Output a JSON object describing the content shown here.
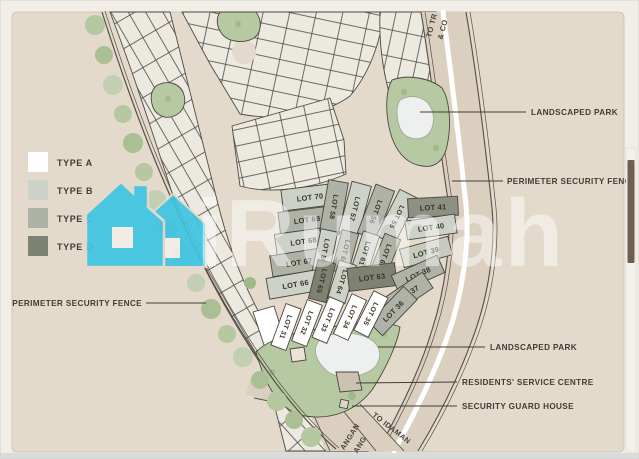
{
  "watermark": {
    "text": "iRumah",
    "house_color": "#3fc5e3"
  },
  "legend": {
    "items": [
      {
        "label": "TYPE A",
        "color": "#ffffff"
      },
      {
        "label": "TYPE B",
        "color": "#cdd2c8"
      },
      {
        "label": "TYPE C",
        "color": "#aeb2a7"
      },
      {
        "label": "TYPE D",
        "color": "#7e8273"
      }
    ]
  },
  "labels": {
    "perimeter_fence_left": "PERIMETER SECURITY FENCE",
    "landscaped_park_top": "LANDSCAPED PARK",
    "perimeter_fence_right": "PERIMETER SECURITY FENCE",
    "landscaped_park_bottom": "LANDSCAPED PARK",
    "residents_service_centre": "RESIDENTS' SERVICE CENTRE",
    "security_guard_house": "SECURITY GUARD HOUSE"
  },
  "road_labels": {
    "top_line1": "TO TR",
    "top_line2": "& CO",
    "bottom_right": "TO IDAMAN",
    "bottom_left_line1": "ANGAN",
    "bottom_left_line2": "ANG"
  },
  "lots": {
    "items": [
      {
        "label": "LOT 70",
        "type": "B",
        "color": "#cdd2c8"
      },
      {
        "label": "LOT 69",
        "type": "C",
        "color": "#aeb2a7"
      },
      {
        "label": "LOT 68",
        "type": "B",
        "color": "#cdd2c8"
      },
      {
        "label": "LOT 67",
        "type": "C",
        "color": "#aeb2a7"
      },
      {
        "label": "LOT 66",
        "type": "B",
        "color": "#cdd2c8"
      },
      {
        "label": "LOT 58",
        "type": "C",
        "color": "#aeb2a7"
      },
      {
        "label": "LOT 57",
        "type": "B",
        "color": "#cdd2c8"
      },
      {
        "label": "LOT 56",
        "type": "C",
        "color": "#aeb2a7"
      },
      {
        "label": "LOT 55",
        "type": "B",
        "color": "#cdd2c8"
      },
      {
        "label": "LOT 59",
        "type": "B",
        "color": "#cdd2c8"
      },
      {
        "label": "LOT 60",
        "type": "C",
        "color": "#aeb2a7"
      },
      {
        "label": "LOT 61",
        "type": "B",
        "color": "#cdd2c8"
      },
      {
        "label": "LOT 62",
        "type": "C",
        "color": "#aeb2a7"
      },
      {
        "label": "LOT 65",
        "type": "D",
        "color": "#7e8273"
      },
      {
        "label": "LOT 64",
        "type": "B",
        "color": "#cdd2c8"
      },
      {
        "label": "LOT 63",
        "type": "D",
        "color": "#7e8273"
      },
      {
        "label": "LOT 41",
        "type": "D",
        "color": "#8d9184"
      },
      {
        "label": "LOT 40",
        "type": "B",
        "color": "#cdd2c8"
      },
      {
        "label": "LOT 39",
        "type": "B",
        "color": "#c6cabf"
      },
      {
        "label": "LOT 38",
        "type": "C",
        "color": "#aeb2a7"
      },
      {
        "label": "LOT 37",
        "type": "C",
        "color": "#aeb2a7"
      },
      {
        "label": "LOT 36",
        "type": "C",
        "color": "#aeb2a7"
      },
      {
        "label": "LOT 31",
        "type": "A",
        "color": "#ffffff"
      },
      {
        "label": "LOT 32",
        "type": "A",
        "color": "#ffffff"
      },
      {
        "label": "LOT 33",
        "type": "A",
        "color": "#ffffff"
      },
      {
        "label": "LOT 34",
        "type": "A",
        "color": "#ffffff"
      },
      {
        "label": "LOT 35",
        "type": "A",
        "color": "#ffffff"
      }
    ]
  }
}
